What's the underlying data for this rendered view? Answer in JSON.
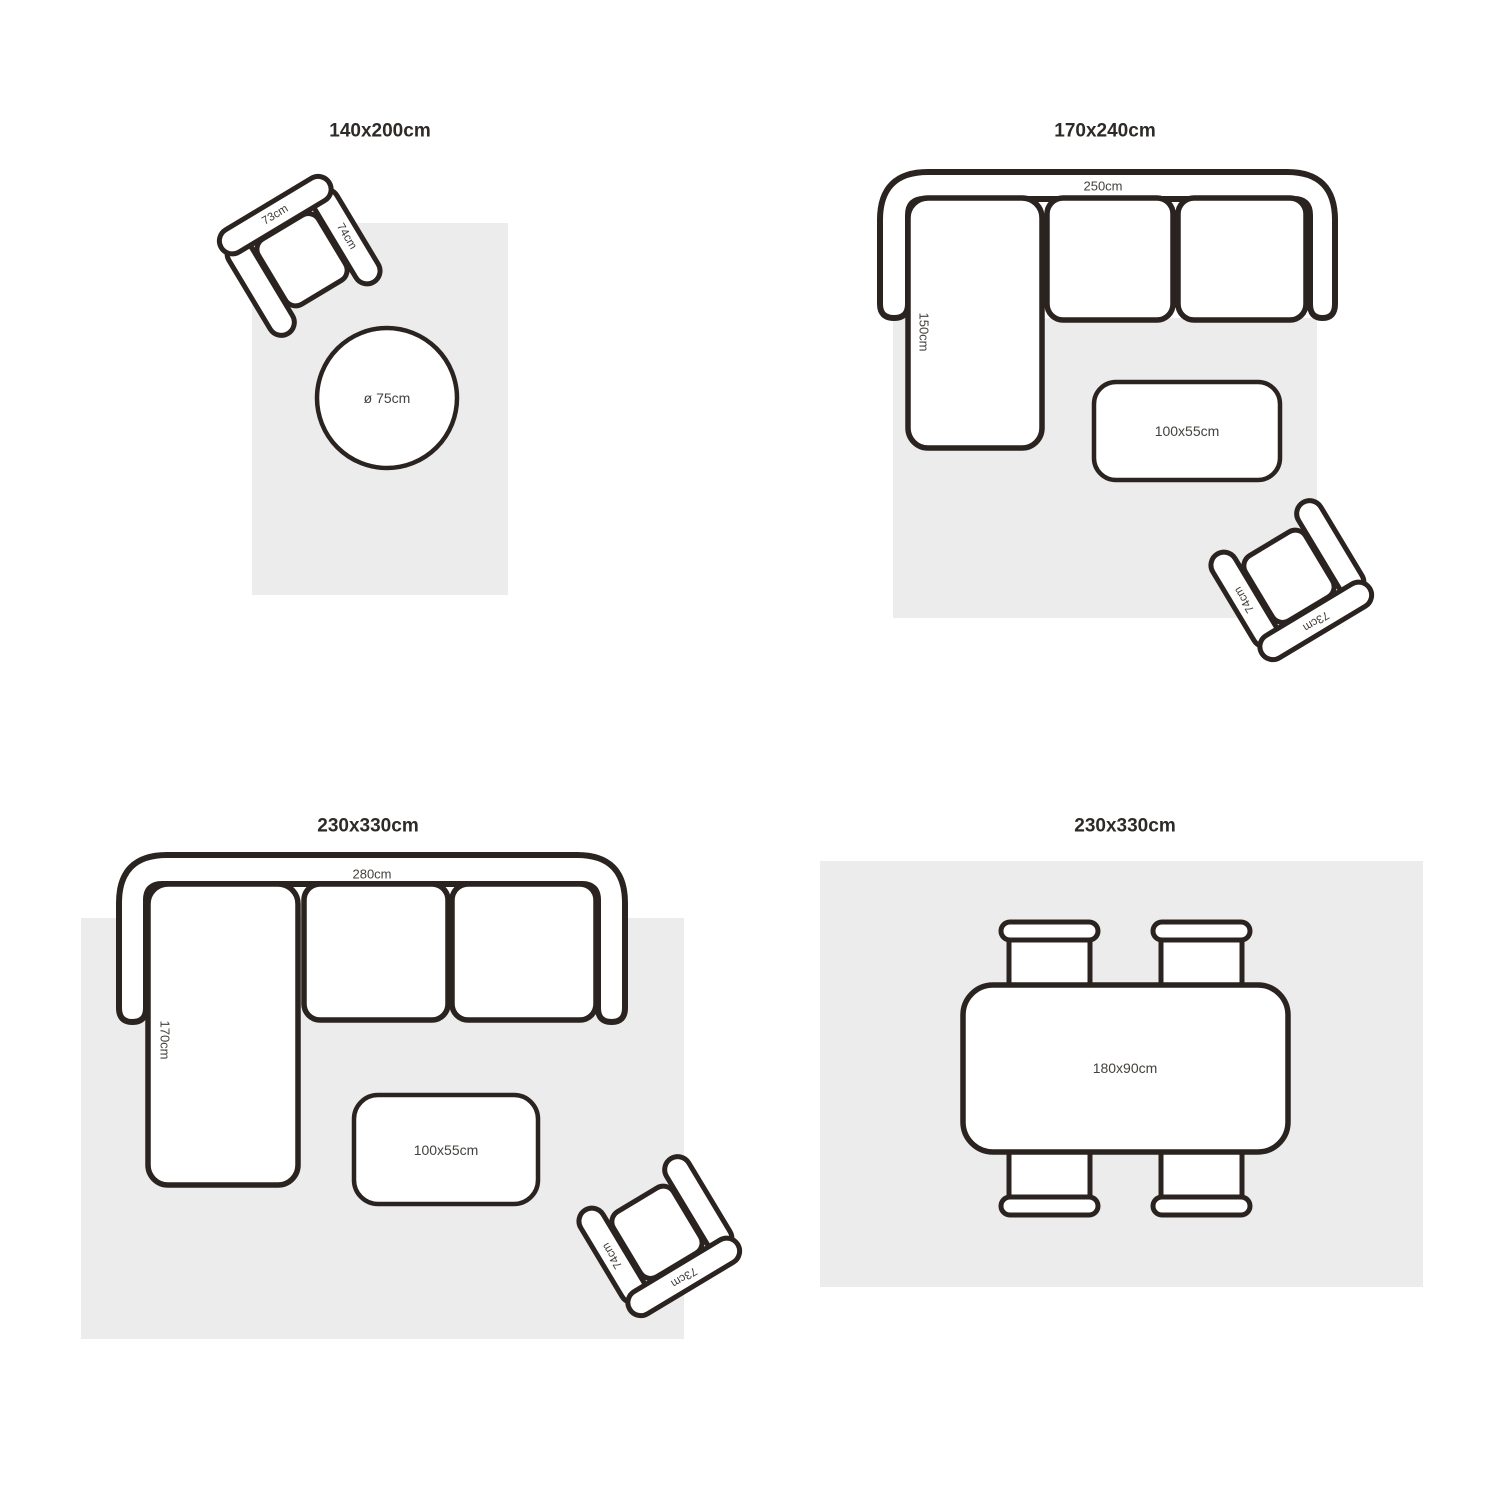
{
  "page": {
    "background": "#ffffff",
    "stroke_color": "#2a2320",
    "rug_color": "#ececec",
    "title_color": "#2d2a27",
    "label_color": "#45413d"
  },
  "layouts": [
    {
      "id": "top-left",
      "title": "140x200cm",
      "labels": {
        "armchair_back": "73cm",
        "armchair_arm": "74cm",
        "round_table": "ø 75cm"
      }
    },
    {
      "id": "top-right",
      "title": "170x240cm",
      "labels": {
        "sofa_width": "250cm",
        "chaise_depth": "150cm",
        "coffee_table": "100x55cm",
        "armchair_back": "73cm",
        "armchair_arm": "74cm"
      }
    },
    {
      "id": "bottom-left",
      "title": "230x330cm",
      "labels": {
        "sofa_width": "280cm",
        "chaise_depth": "170cm",
        "coffee_table": "100x55cm",
        "armchair_back": "73cm",
        "armchair_arm": "74cm"
      }
    },
    {
      "id": "bottom-right",
      "title": "230x330cm",
      "labels": {
        "dining_table": "180x90cm"
      }
    }
  ]
}
